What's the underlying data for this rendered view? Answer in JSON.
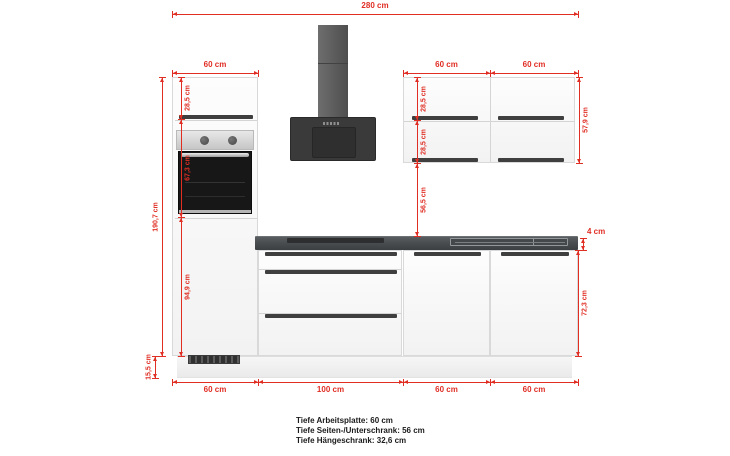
{
  "diagram": {
    "accent_red": "#e02e24",
    "worktop_color": "#4a4d50",
    "hood_color": "#3a3a3a",
    "dimensions": [
      {
        "name": "total-width",
        "label": "280 cm",
        "dir": "h",
        "x": 172,
        "y": 14,
        "len": 406,
        "side": "above"
      },
      {
        "name": "tall-cabinet-width",
        "label": "60 cm",
        "dir": "h",
        "x": 172,
        "y": 73,
        "len": 86,
        "side": "above"
      },
      {
        "name": "wall-cabinet-1-width",
        "label": "60 cm",
        "dir": "h",
        "x": 403,
        "y": 73,
        "len": 87,
        "side": "above"
      },
      {
        "name": "wall-cabinet-2-width",
        "label": "60 cm",
        "dir": "h",
        "x": 490,
        "y": 73,
        "len": 88,
        "side": "above"
      },
      {
        "name": "tall-cabinet-height",
        "label": "190,7 cm",
        "dir": "v",
        "x": 162,
        "y": 77,
        "len": 279,
        "side": "left"
      },
      {
        "name": "plinth-height",
        "label": "15,5 cm",
        "dir": "v",
        "x": 155,
        "y": 356,
        "len": 22,
        "side": "left"
      },
      {
        "name": "tall-top-door-height",
        "label": "28,5 cm",
        "dir": "v",
        "x": 181,
        "y": 77,
        "len": 42,
        "side": "right"
      },
      {
        "name": "oven-niche-height",
        "label": "67,3 cm",
        "dir": "v",
        "x": 181,
        "y": 119,
        "len": 98,
        "side": "right"
      },
      {
        "name": "tall-lower-door-height",
        "label": "94,9 cm",
        "dir": "v",
        "x": 181,
        "y": 217,
        "len": 139,
        "side": "right"
      },
      {
        "name": "wall-door-upper-height",
        "label": "28,5 cm",
        "dir": "v",
        "x": 417,
        "y": 77,
        "len": 43,
        "side": "right"
      },
      {
        "name": "wall-door-lower-height",
        "label": "28,5 cm",
        "dir": "v",
        "x": 417,
        "y": 120,
        "len": 43,
        "side": "right"
      },
      {
        "name": "wall-to-worktop-gap",
        "label": "56,5 cm",
        "dir": "v",
        "x": 417,
        "y": 163,
        "len": 73,
        "side": "right"
      },
      {
        "name": "wall-cabinet-height",
        "label": "57,9 cm",
        "dir": "v",
        "x": 579,
        "y": 77,
        "len": 86,
        "side": "right"
      },
      {
        "name": "worktop-thickness",
        "label": "4 cm",
        "dir": "v",
        "x": 583,
        "y": 238,
        "len": 12,
        "side": "right",
        "rotate": false,
        "dx": -3,
        "dy": -12
      },
      {
        "name": "base-cabinet-height",
        "label": "72,3 cm",
        "dir": "v",
        "x": 578,
        "y": 250,
        "len": 106,
        "side": "right"
      },
      {
        "name": "bottom-tall-width",
        "label": "60 cm",
        "dir": "h",
        "x": 172,
        "y": 382,
        "len": 86,
        "side": "below"
      },
      {
        "name": "bottom-drawer-unit-width",
        "label": "100 cm",
        "dir": "h",
        "x": 258,
        "y": 382,
        "len": 145,
        "side": "below"
      },
      {
        "name": "bottom-base-1-width",
        "label": "60 cm",
        "dir": "h",
        "x": 403,
        "y": 382,
        "len": 87,
        "side": "below"
      },
      {
        "name": "bottom-base-2-width",
        "label": "60 cm",
        "dir": "h",
        "x": 490,
        "y": 382,
        "len": 88,
        "side": "below"
      }
    ]
  },
  "footer": {
    "lines": [
      "Tiefe Arbeitsplatte: 60 cm",
      "Tiefe Seiten-/Unterschrank: 56 cm",
      "Tiefe Hängeschrank: 32,6 cm"
    ]
  }
}
